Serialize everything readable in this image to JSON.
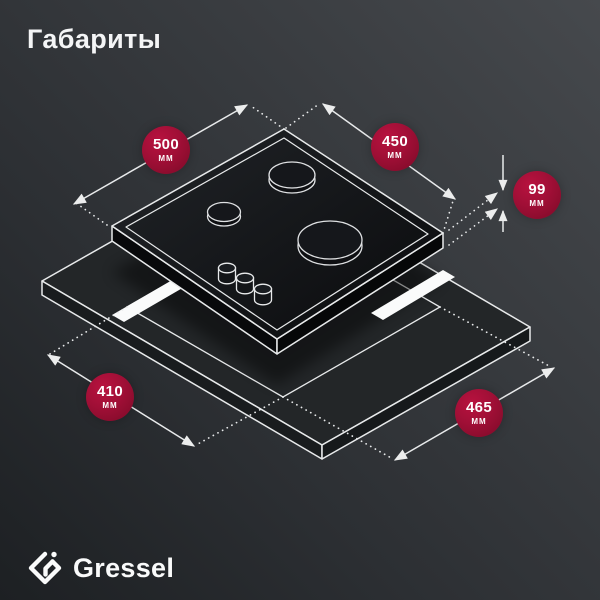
{
  "title": "Габариты",
  "brand": {
    "name": "Gressel"
  },
  "diagram": {
    "subject": "gas-hob-with-countertop-cutout",
    "dimensions": [
      {
        "id": "hob-width",
        "value": "500",
        "unit": "мм"
      },
      {
        "id": "hob-depth",
        "value": "450",
        "unit": "мм"
      },
      {
        "id": "hob-height",
        "value": "99",
        "unit": "мм"
      },
      {
        "id": "cutout-depth",
        "value": "410",
        "unit": "мм"
      },
      {
        "id": "cutout-width",
        "value": "465",
        "unit": "мм"
      }
    ],
    "colors": {
      "badge": "#A00F36",
      "line": "#E8EAEB",
      "panel": "#0C0D0F",
      "cutout_glow": "#FAFBFB"
    }
  }
}
